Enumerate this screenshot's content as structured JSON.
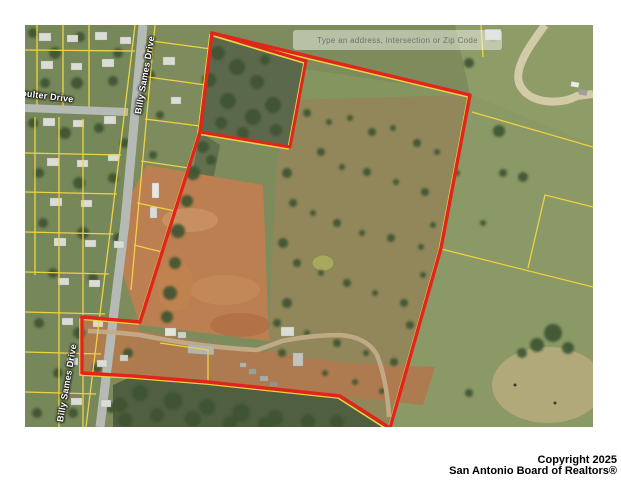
{
  "window": {
    "width": 621,
    "height": 480,
    "background": "#ffffff"
  },
  "map": {
    "kind": "aerial-parcel-map",
    "watermark_text": "Type an address, intersection or Zip Code",
    "street_labels": [
      {
        "id": "billy-sames-upper",
        "text": "Billy Sames Drive"
      },
      {
        "id": "billy-sames-lower",
        "text": "Billy Sames Drive"
      },
      {
        "id": "coulter-drive",
        "text": "oulter Drive"
      }
    ],
    "colors": {
      "subject_boundary_red": "#e1251b",
      "parcel_line_yellow": "#eed243",
      "road_gray": "#b6bab4",
      "dirt_brown": "#bb7f51",
      "field_green": "#8a9965",
      "woods_green": "#4f5f3f"
    }
  },
  "copyright": {
    "line1": "Copyright 2025",
    "line2": "San Antonio Board of Realtors®"
  }
}
